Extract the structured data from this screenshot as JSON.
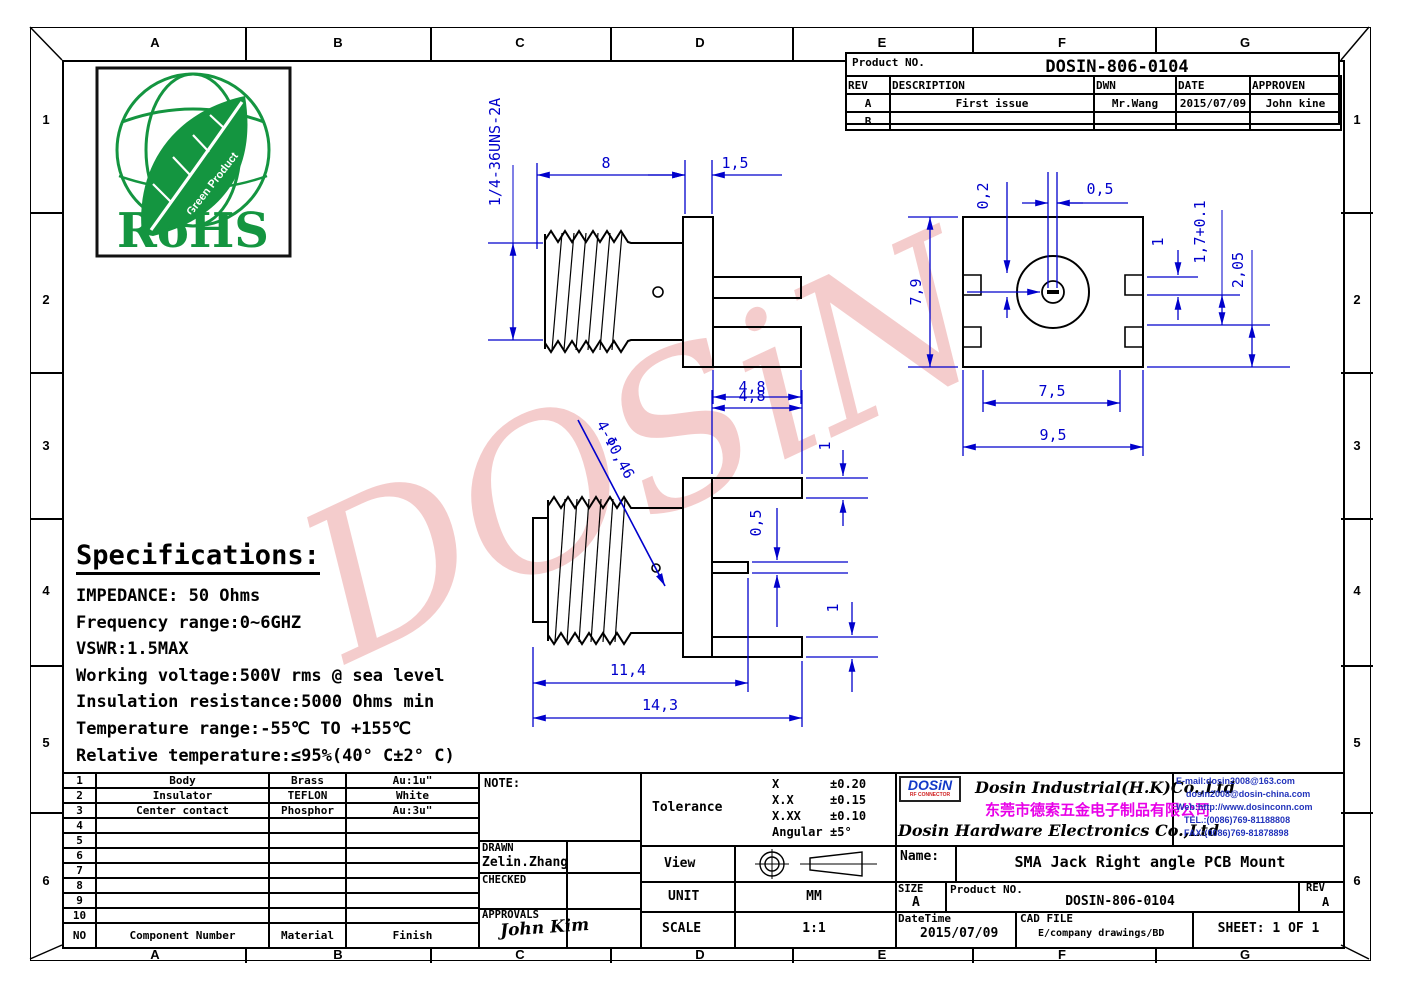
{
  "page": {
    "watermark": "DOSiN",
    "colors": {
      "dimension_blue": "#0000cc",
      "drawing_black": "#000000",
      "watermark_pink": "#eb9a9a",
      "rohs_green": "#149540",
      "logo_blue": "#1238c8",
      "company_magenta": "#e800e8",
      "contact_blue": "#2233bb"
    }
  },
  "border": {
    "top": [
      "A",
      "B",
      "C",
      "D",
      "E",
      "F",
      "G"
    ],
    "bottom": [
      "A",
      "B",
      "C",
      "D",
      "E",
      "F",
      "G"
    ],
    "left": [
      "1",
      "2",
      "3",
      "4",
      "5",
      "6"
    ],
    "right": [
      "1",
      "2",
      "3",
      "4",
      "5",
      "6"
    ]
  },
  "rohs": {
    "title": "RoHS",
    "arc_label": "Green Product"
  },
  "revision_table": {
    "product_label": "Product NO.",
    "product_no": "DOSIN-806-0104",
    "headers": [
      "REV",
      "DESCRIPTION",
      "DWN",
      "DATE",
      "APPROVEN"
    ],
    "row_a": {
      "rev": "A",
      "description": "First issue",
      "dwn": "Mr.Wang",
      "date": "2015/07/09",
      "approven": "John kine"
    },
    "row_b": {
      "rev": "B",
      "description": "",
      "dwn": "",
      "date": "",
      "approven": ""
    }
  },
  "specs": {
    "title": "Specifications:",
    "lines": [
      "IMPEDANCE: 50 Ohms",
      "Frequency range:0~6GHZ",
      "VSWR:1.5MAX",
      "Working voltage:500V rms @ sea level",
      "Insulation resistance:5000 Ohms min",
      "Temperature range:-55℃ TO +155℃",
      "Relative temperature:≤95%(40° C±2° C)"
    ]
  },
  "views": {
    "view1": {
      "thread_spec": "1/4-36UNS-2A",
      "len": "8",
      "flange": "1,5",
      "pin_w": "4,8"
    },
    "view2": {
      "height": "7,9",
      "notch": "0,2",
      "slot": "0,5",
      "d1": "1",
      "d2": "1,7+0.1",
      "d3": "2,05",
      "w1": "7,5",
      "w2": "9,5"
    },
    "view3": {
      "holes": "4-Φ0,46",
      "top": "4,8",
      "t1": "1",
      "t2": "0,5",
      "t3": "1",
      "len1": "11,4",
      "len2": "14,3"
    }
  },
  "parts_table": {
    "header": {
      "no": "NO",
      "component": "Component Number",
      "material": "Material",
      "finish": "Finish"
    },
    "rows": [
      {
        "no": "1",
        "component": "Body",
        "material": "Brass",
        "finish": "Au:1u\""
      },
      {
        "no": "2",
        "component": "Insulator",
        "material": "TEFLON",
        "finish": "White"
      },
      {
        "no": "3",
        "component": "Center contact",
        "material": "Phosphor",
        "finish": "Au:3u\""
      },
      {
        "no": "4"
      },
      {
        "no": "5"
      },
      {
        "no": "6"
      },
      {
        "no": "7"
      },
      {
        "no": "8"
      },
      {
        "no": "9"
      },
      {
        "no": "10"
      }
    ]
  },
  "title_block": {
    "note_label": "NOTE:",
    "drawn_label": "DRAWN",
    "drawn_name": "Zelin.Zhang",
    "checked_label": "CHECKED",
    "approvals_label": "APPROVALS",
    "approvals_sign": "John Kim",
    "tolerance_label": "Tolerance",
    "tol": [
      {
        "k": "X",
        "v": "±0.20"
      },
      {
        "k": "X.X",
        "v": "±0.15"
      },
      {
        "k": "X.XX",
        "v": "±0.10"
      },
      {
        "k": "Angular",
        "v": "±5°"
      }
    ],
    "view_label": "View",
    "unit_label": "UNIT",
    "unit_value": "MM",
    "scale_label": "SCALE",
    "scale_value": "1:1"
  },
  "company": {
    "logo": "DOSiN",
    "logo_sub": "RF CONNECTOR",
    "name_en1": "Dosin Industrial(H.K)Co.,Ltd",
    "name_cn": "东莞市德索五金电子制品有限公司",
    "name_en2": "Dosin Hardware Electronics Co.,Ltd",
    "contact_lines": [
      "E-mail:dosin2008@163.com",
      "dosin2008@dosin-china.com",
      "Web:http://www.dosinconn.com",
      "TEL.:(0086)769-81188808",
      "FAX:(0086)769-81878898"
    ]
  },
  "name_block": {
    "name_label": "Name:",
    "name_value": "SMA Jack Right angle PCB Mount",
    "size_label": "SIZE",
    "size_value": "A",
    "product_label": "Product NO.",
    "product_no": "DOSIN-806-0104",
    "rev_label": "REV",
    "rev_value": "A",
    "datetime_label": "DateTime",
    "datetime_value": "2015/07/09",
    "cad_label": "CAD FILE",
    "cad_value": "E/company drawings/BD",
    "sheet_label": "SHEET: 1 OF 1"
  }
}
